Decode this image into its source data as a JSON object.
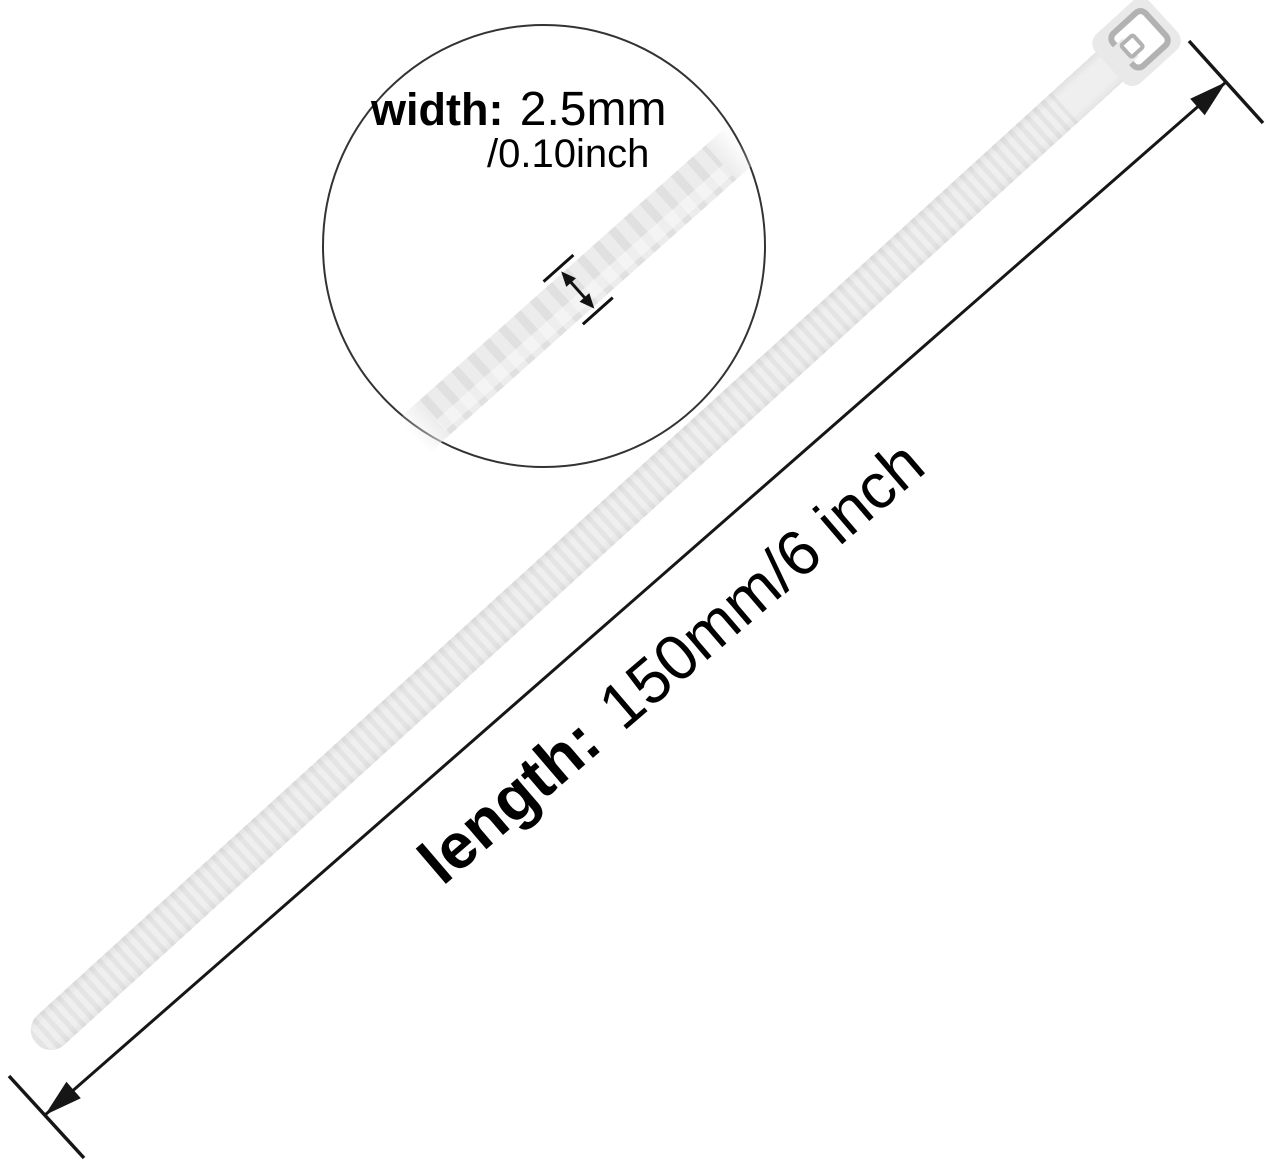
{
  "annotations": {
    "width": {
      "label": "width:",
      "value_mm": "2.5mm",
      "value_inch": "/0.10inch"
    },
    "length": {
      "label": "length:",
      "value": "150mm/6 inch"
    }
  },
  "colors": {
    "background": "#ffffff",
    "tie_body": "#efefef",
    "tie_serration": "#e4e4e4",
    "tie_head": "#e9e9e9",
    "head_slot_outline": "#b2b2b2",
    "magnified_band": "#ececec",
    "magnified_serration": "#e0e0e0",
    "magnifier_circle_stroke": "#333333",
    "dimension_line": "#161616",
    "text": "#000000"
  }
}
